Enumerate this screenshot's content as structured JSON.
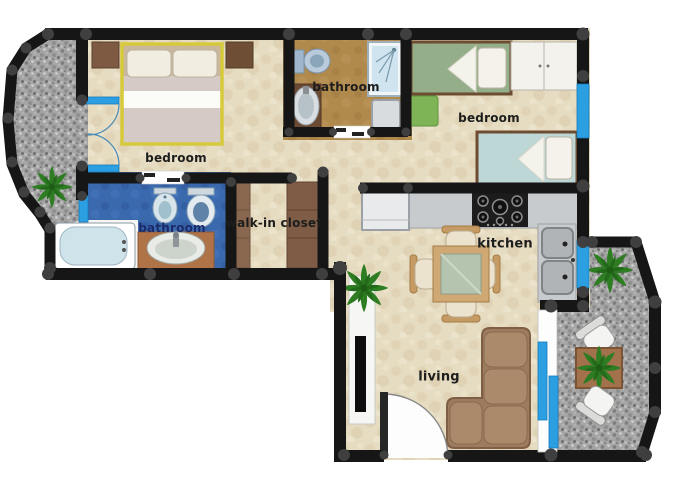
{
  "plan": {
    "type": "apartment-floor-plan",
    "rooms": [
      {
        "id": "bedroom-main",
        "label": "bedroom"
      },
      {
        "id": "bathroom-top",
        "label": "bathroom"
      },
      {
        "id": "bedroom-second",
        "label": "bedroom"
      },
      {
        "id": "bathroom-main",
        "label": "bathroom"
      },
      {
        "id": "walk-in-closet",
        "label": "walk-in closet"
      },
      {
        "id": "kitchen",
        "label": "kitchen"
      },
      {
        "id": "living",
        "label": "living"
      }
    ],
    "furniture_items": [
      "double-bed",
      "nightstand",
      "french-door",
      "bathtub",
      "washbasin",
      "bidet",
      "toilet",
      "shower",
      "washing-machine",
      "single-bed",
      "wardrobe",
      "rug",
      "fridge",
      "cooktop",
      "kitchen-sink",
      "dining-table",
      "dining-chair",
      "corner-sofa",
      "tv-stand",
      "entry-door",
      "plant",
      "patio-table",
      "patio-chair",
      "balcony",
      "sliding-window"
    ],
    "colors": {
      "wall": "#161616",
      "post": "#3f3f3f",
      "floor_main": "#e6dcc2",
      "floor_bathroom_top": "#b0894d",
      "floor_bathroom_left": "#3a69ae",
      "stone_gray": "#a5a5a5",
      "window_blue": "#2b9fe2",
      "bed_frame_yellow": "#d6c93b",
      "blanket_mauve": "#d5cac6",
      "mattress_green": "#93ae89",
      "mattress_blue": "#bdd7d6",
      "sofa_brown": "#a5866a",
      "counter_gray": "#c8cbcd",
      "wardrobe_brown": "#85624b",
      "plant_green": "#2e7d23",
      "label_navy": "#1b2a6b"
    }
  }
}
